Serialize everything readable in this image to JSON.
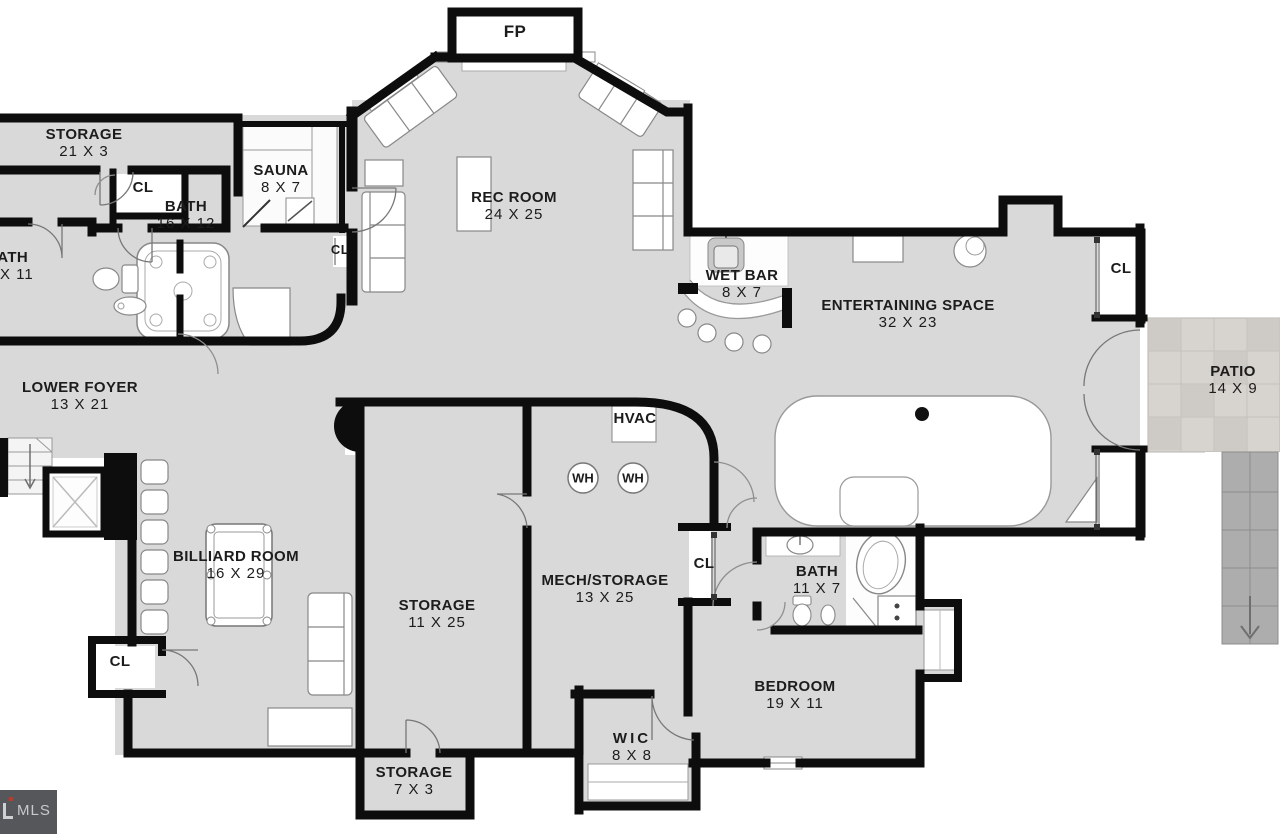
{
  "plan": {
    "title": "Lower level floor plan",
    "watermark": {
      "brand": "MLS"
    },
    "rooms": {
      "fp": {
        "label": "FP"
      },
      "storage_top": {
        "label": "STORAGE",
        "size": "21 X 3"
      },
      "sauna": {
        "label": "SAUNA",
        "size": "8 X 7"
      },
      "bath_main": {
        "label": "BATH",
        "size": "16 X 12"
      },
      "bath_left": {
        "label": "BATH",
        "size": "X 11"
      },
      "rec_room": {
        "label": "REC ROOM",
        "size": "24 X 25"
      },
      "wet_bar": {
        "label": "WET BAR",
        "size": "8 X 7"
      },
      "entertaining": {
        "label": "ENTERTAINING SPACE",
        "size": "32 X 23"
      },
      "patio": {
        "label": "PATIO",
        "size": "14 X 9"
      },
      "lower_foyer": {
        "label": "LOWER FOYER",
        "size": "13 X 21"
      },
      "hvac": {
        "label": "HVAC"
      },
      "water_heater": {
        "label": "WH"
      },
      "billiard": {
        "label": "BILLIARD ROOM",
        "size": "16 X 29"
      },
      "storage_mid": {
        "label": "STORAGE",
        "size": "11 X 25"
      },
      "mech_storage": {
        "label": "MECH/STORAGE",
        "size": "13 X 25"
      },
      "bath_lower": {
        "label": "BATH",
        "size": "11 X 7"
      },
      "bedroom": {
        "label": "BEDROOM",
        "size": "19 X 11"
      },
      "wic": {
        "label": "WIC",
        "size": "8 X 8"
      },
      "storage_small": {
        "label": "STORAGE",
        "size": "7 X 3"
      },
      "closet": {
        "label": "CL"
      }
    },
    "colors": {
      "floor": "#d9d9d9",
      "wall": "#0d0d0d",
      "fixture_line": "#8a8a8a",
      "patio": "#d7d3cf",
      "stairs": "#adadad",
      "watermark_bg": "#56575a",
      "watermark_text": "#c8c9cb",
      "logo_red": "#c0392b"
    }
  }
}
